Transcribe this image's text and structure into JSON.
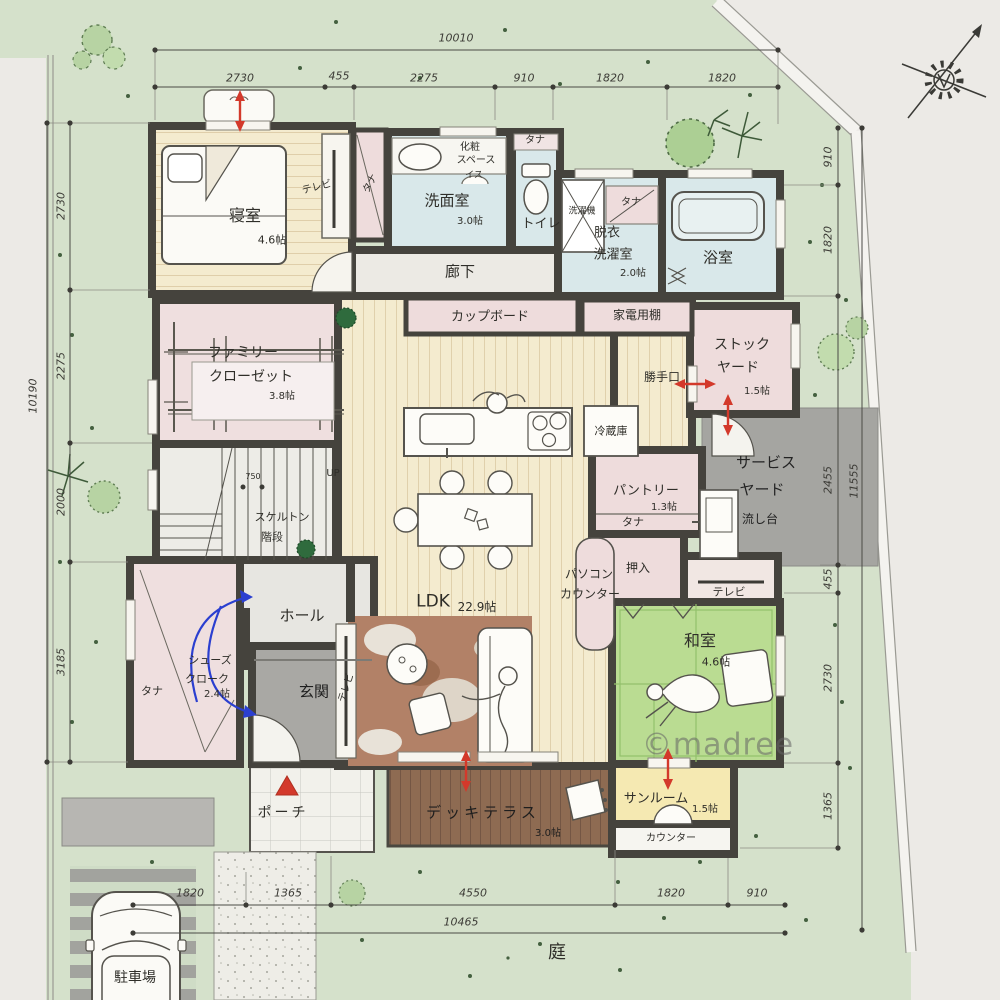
{
  "watermark": "©madree",
  "site": {
    "garden": "庭"
  },
  "labels": {
    "tana": "タナ",
    "tv": "テレビ",
    "up": "UP",
    "stair_width": "750"
  },
  "rooms": {
    "bedroom": {
      "name": "寝室",
      "size": "4.6帖"
    },
    "washroom": {
      "name": "洗面室",
      "size": "3.0帖",
      "makeup_l1": "化粧",
      "makeup_l2": "スペース",
      "chair": "イス"
    },
    "toilet": {
      "name": "トイレ"
    },
    "laundry": {
      "l1": "脱衣",
      "l2": "洗濯室",
      "size": "2.0帖",
      "washer": "洗濯機"
    },
    "bath": {
      "name": "浴室"
    },
    "corridor": {
      "name": "廊下"
    },
    "family_closet": {
      "l1": "ファミリー",
      "l2": "クローゼット",
      "size": "3.8帖"
    },
    "stairs": {
      "l1": "スケルトン",
      "l2": "階段"
    },
    "cupboard": {
      "name": "カップボード"
    },
    "appliance_shelf": {
      "name": "家電用棚"
    },
    "kitchen_door": {
      "name": "勝手口"
    },
    "stock_yard": {
      "l1": "ストック",
      "l2": "ヤード",
      "size": "1.5帖"
    },
    "fridge": {
      "name": "冷蔵庫"
    },
    "service_yard": {
      "l1": "サービス",
      "l2": "ヤード"
    },
    "sink_stand": {
      "name": "流し台"
    },
    "pantry": {
      "name": "パントリー",
      "size": "1.3帖"
    },
    "oshiire": {
      "name": "押入"
    },
    "pc_counter": {
      "l1": "パソコン",
      "l2": "カウンター"
    },
    "ldk": {
      "name": "LDK",
      "size": "22.9帖"
    },
    "washitsu": {
      "name": "和室",
      "size": "4.6帖"
    },
    "hall": {
      "name": "ホール"
    },
    "shoes_closet": {
      "l1": "シューズ",
      "l2": "クローク",
      "size": "2.4帖"
    },
    "genkan": {
      "name": "玄関"
    },
    "porch": {
      "name": "ポーチ"
    },
    "deck": {
      "name": "デッキテラス",
      "size": "3.0帖"
    },
    "sunroom": {
      "name": "サンルーム",
      "size": "1.5帖"
    },
    "counter": {
      "name": "カウンター"
    },
    "parking": {
      "name": "駐車場"
    }
  },
  "dimensions": {
    "top": {
      "overall": "10010",
      "segments": [
        "2730",
        "455",
        "2275",
        "910",
        "1820",
        "1820"
      ]
    },
    "left": {
      "overall": "10190",
      "segments": [
        "2730",
        "2275",
        "2000",
        "3185"
      ]
    },
    "right": {
      "overall": "11555",
      "segments": [
        "910",
        "1820",
        "2455",
        "455",
        "2730",
        "1365"
      ]
    },
    "bottom": {
      "overall": "10465",
      "segments": [
        "1820",
        "1365",
        "4550",
        "1820",
        "910"
      ]
    }
  },
  "colors": {
    "site_green": "#d5e1cb",
    "wall": "#45433d",
    "wood": "#f4ebcf",
    "pink": "#eedcdc",
    "wet_blue": "#d9e8ea",
    "tatami": "#badc92",
    "sunroom_yellow": "#f5e9b2",
    "deck_brown": "#8e6b52",
    "concrete": "#a5a5a1",
    "accent_red": "#d3392b",
    "accent_blue": "#2b3fd0"
  }
}
